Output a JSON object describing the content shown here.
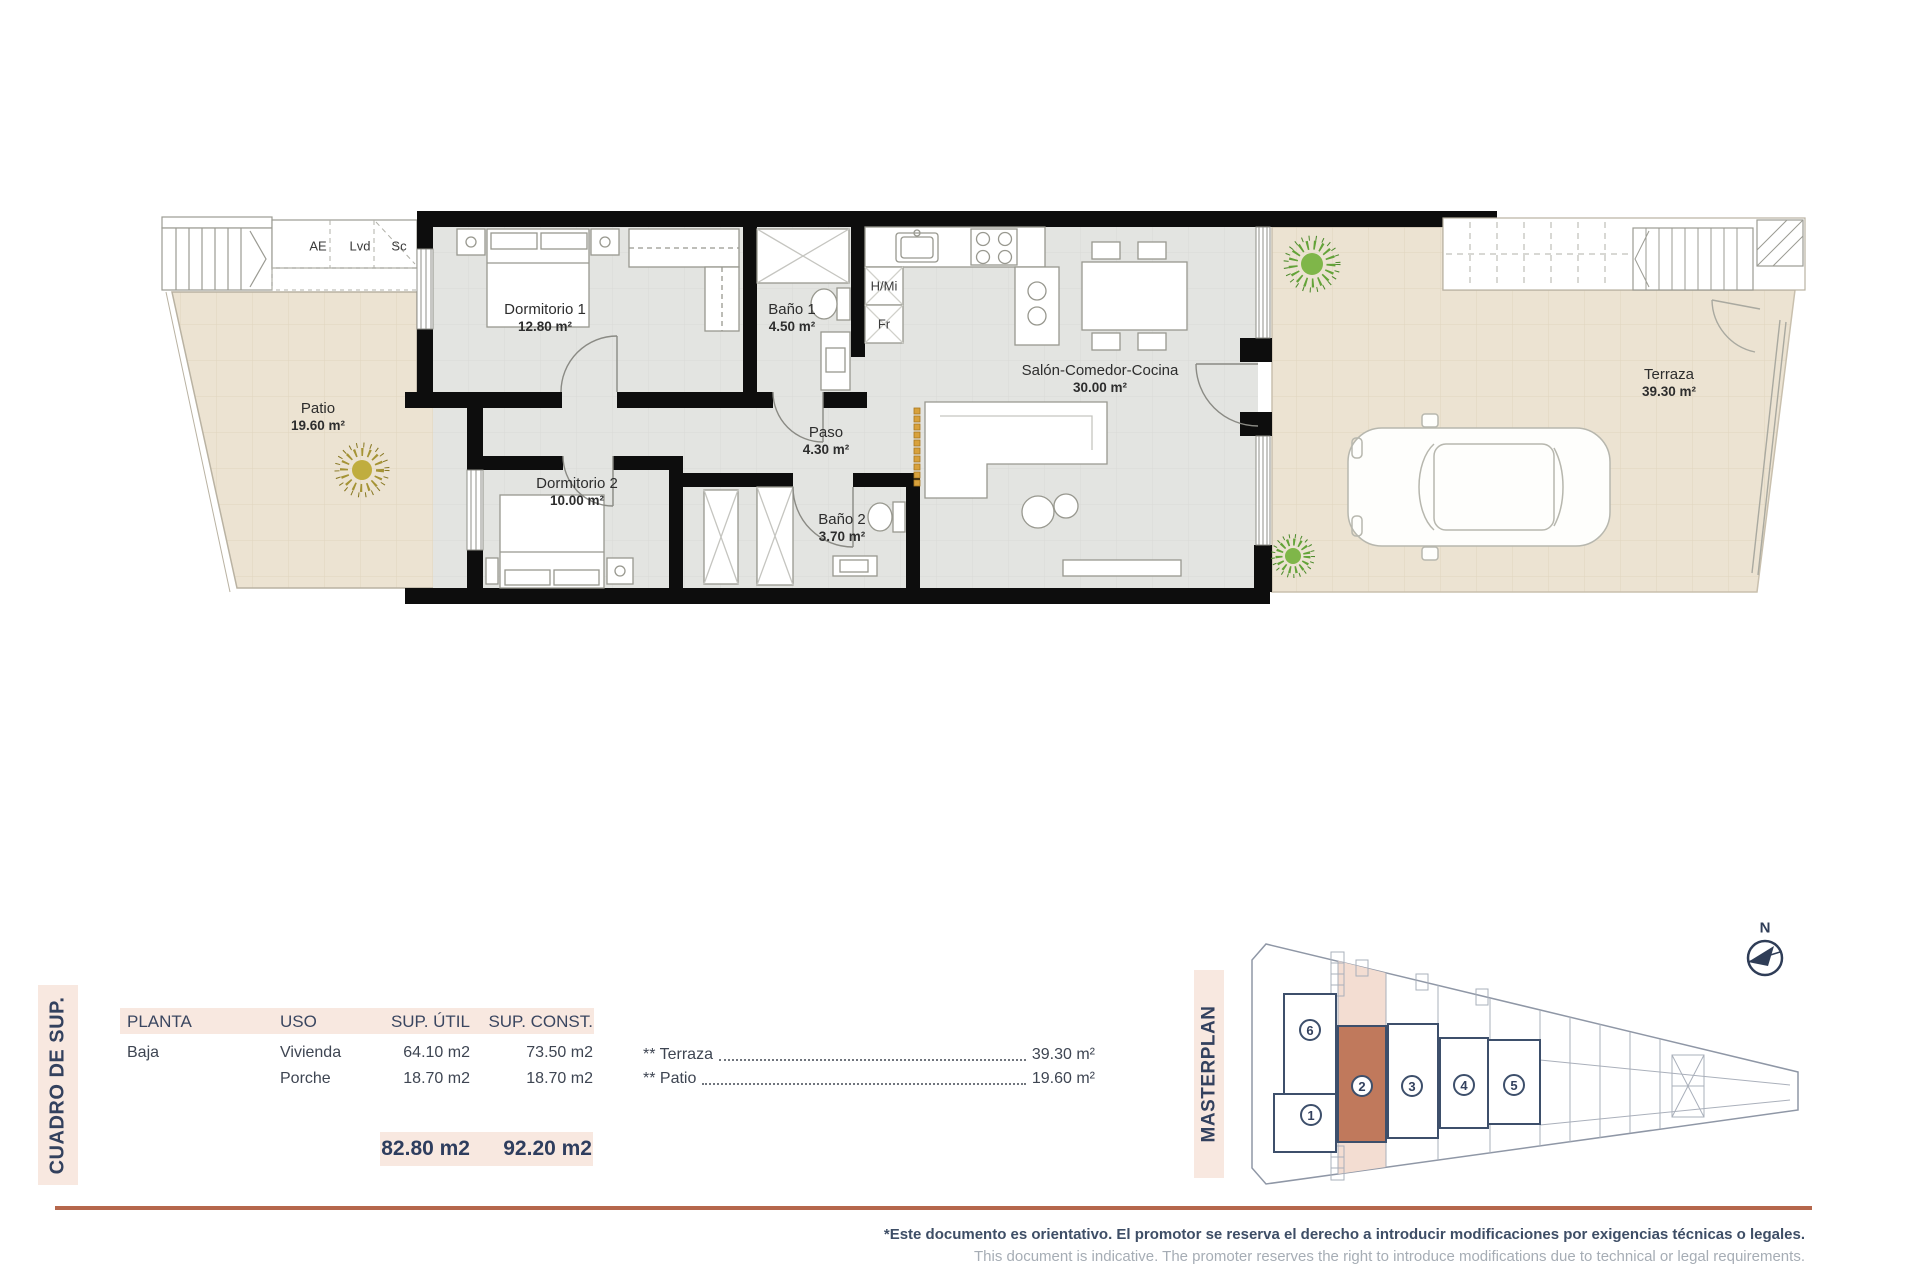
{
  "plan": {
    "rooms": [
      {
        "id": "patio",
        "name": "Patio",
        "area": "19.60 m²"
      },
      {
        "id": "dormitorio1",
        "name": "Dormitorio 1",
        "area": "12.80 m²"
      },
      {
        "id": "dormitorio2",
        "name": "Dormitorio 2",
        "area": "10.00 m²"
      },
      {
        "id": "bano1",
        "name": "Baño 1",
        "area": "4.50 m²"
      },
      {
        "id": "bano2",
        "name": "Baño 2",
        "area": "3.70 m²"
      },
      {
        "id": "paso",
        "name": "Paso",
        "area": "4.30 m²"
      },
      {
        "id": "salon",
        "name": "Salón-Comedor-Cocina",
        "area": "30.00 m²"
      },
      {
        "id": "terraza",
        "name": "Terraza",
        "area": "39.30 m²"
      }
    ],
    "closets": [
      {
        "label": "AE"
      },
      {
        "label": "Lvd"
      },
      {
        "label": "Sc"
      }
    ],
    "appliances": [
      {
        "label": "H/Mi"
      },
      {
        "label": "Fr"
      }
    ]
  },
  "summary": {
    "side_label": "CUADRO DE SUP.",
    "table": {
      "headers": [
        "PLANTA",
        "USO",
        "SUP. ÚTIL",
        "SUP. CONST."
      ],
      "rows": [
        {
          "planta": "Baja",
          "uso": "Vivienda",
          "sup_util": "64.10 m2",
          "sup_const": "73.50 m2"
        },
        {
          "planta": "",
          "uso": "Porche",
          "sup_util": "18.70 m2",
          "sup_const": "18.70 m2"
        }
      ],
      "total_util": "82.80 m2",
      "total_const": "92.20 m2"
    },
    "extras": [
      {
        "label": "** Terraza",
        "value": "39.30 m²"
      },
      {
        "label": "** Patio",
        "value": "19.60 m²"
      }
    ]
  },
  "masterplan": {
    "side_label": "MASTERPLAN",
    "north_label": "N",
    "units": [
      {
        "num": "1"
      },
      {
        "num": "2"
      },
      {
        "num": "3"
      },
      {
        "num": "4"
      },
      {
        "num": "5"
      },
      {
        "num": "6"
      }
    ],
    "highlighted_unit": "2"
  },
  "footer": {
    "disclaimer_es": "*Este documento es orientativo. El promotor se reserva el derecho a introducir modificaciones por exigencias técnicas o legales.",
    "disclaimer_en": "This document is indicative. The promoter reserves the right to introduce modifications due to technical or legal requirements."
  },
  "colors": {
    "accent_terracotta": "#b5674c",
    "navy": "#2e3d5e",
    "pink_band": "#f8e8e0",
    "highlight_unit": "#c0795c",
    "pink_strip": "#f3ddd2"
  }
}
